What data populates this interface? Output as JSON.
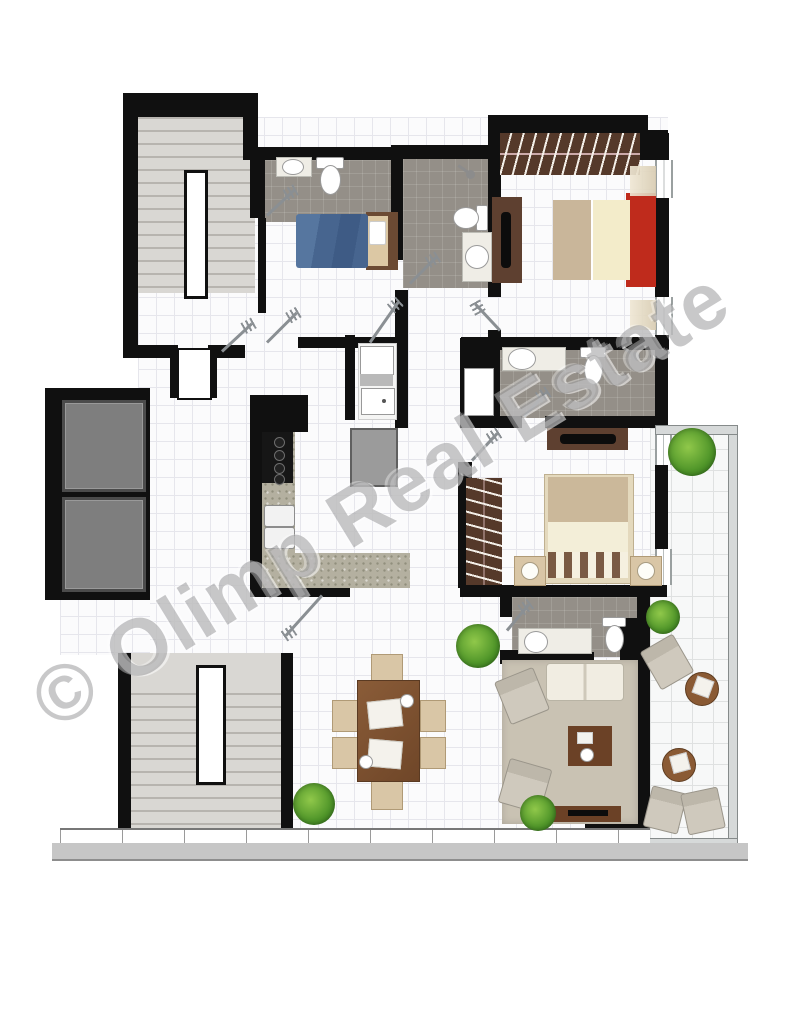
{
  "watermark": {
    "text": "© Olimp Real Estate"
  },
  "palette": {
    "wall": "#101010",
    "bathroom_tile": "#948f88",
    "stair": "#d9d7d3",
    "wood_dark": "#5e4030",
    "counter_granite": "#b4b0a0",
    "bed_cream": "#f3ecca",
    "bed_accent_red": "#bf2b1c",
    "bed_blue": "#4b6b9d",
    "rug": "#c9c2b3",
    "furniture_beige": "#d9c6a6",
    "plant_green": "#4f9529",
    "elevator_gray": "#7e7e7e"
  },
  "plan": {
    "type": "apartment-floor-plan",
    "core_features": [
      "upper-staircase",
      "lower-staircase",
      "two-elevator-shafts",
      "entrance-door"
    ],
    "rooms": [
      "entry-hall",
      "guest-bathroom",
      "single-bedroom",
      "ensuite-bathroom",
      "bedroom-top-right",
      "master-bathroom",
      "master-bedroom",
      "laundry-closet",
      "kitchen",
      "dining-area",
      "living-room",
      "living-bathroom",
      "terrace"
    ],
    "furniture": [
      "single-bed",
      "double-bed-red-frame",
      "double-bed-master",
      "wardrobes-with-hangers",
      "tv-cabinets",
      "kitchen-counter-l-shape",
      "cooktop",
      "double-kitchen-sink",
      "fridge",
      "washing-machine",
      "laundry-sink",
      "dining-table-with-six-chairs",
      "sofa",
      "two-armchairs",
      "coffee-table",
      "lounge-chairs",
      "round-side-tables",
      "potted-plants",
      "toilets",
      "washbasins",
      "shower-heads"
    ]
  }
}
